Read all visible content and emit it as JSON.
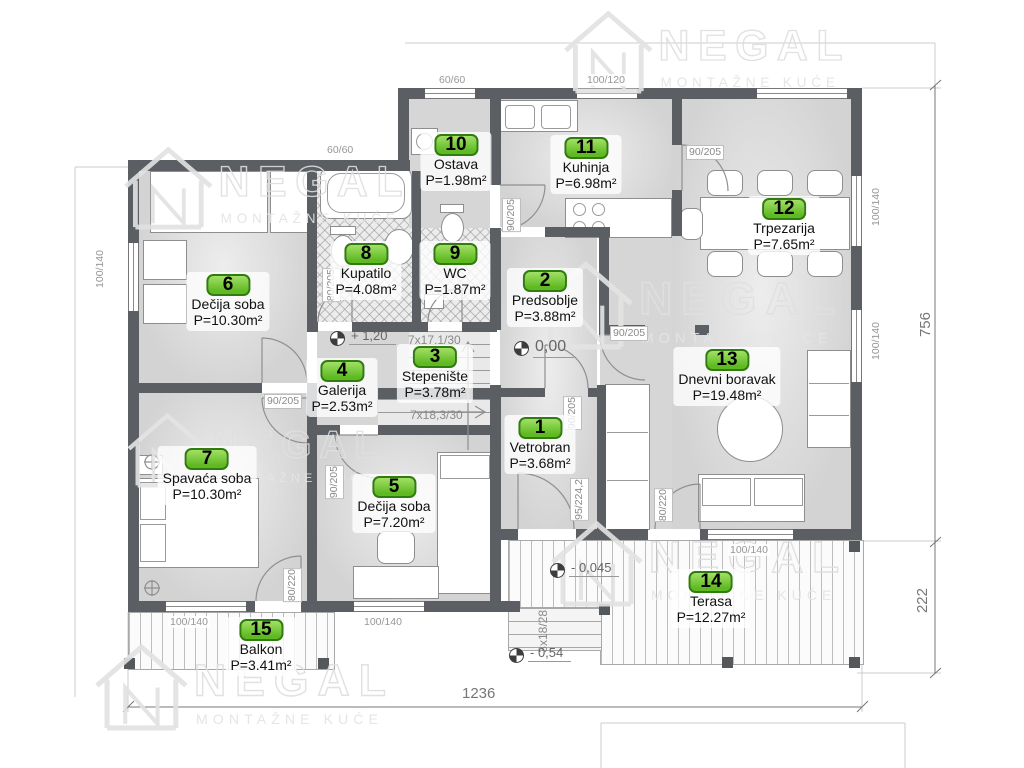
{
  "brand": {
    "name": "NEGAL",
    "tagline": "MONTAŽNE KUĆE"
  },
  "rooms": [
    {
      "num": "1",
      "name": "Vetrobran",
      "area": "P=3.68m²"
    },
    {
      "num": "2",
      "name": "Predsoblje",
      "area": "P=3.88m²"
    },
    {
      "num": "3",
      "name": "Stepenište",
      "area": "P=3.78m²"
    },
    {
      "num": "4",
      "name": "Galerija",
      "area": "P=2.53m²"
    },
    {
      "num": "5",
      "name": "Dečija soba",
      "area": "P=7.20m²"
    },
    {
      "num": "6",
      "name": "Dečija soba",
      "area": "P=10.30m²"
    },
    {
      "num": "7",
      "name": "Spavaća soba",
      "area": "P=10.30m²"
    },
    {
      "num": "8",
      "name": "Kupatilo",
      "area": "P=4.08m²"
    },
    {
      "num": "9",
      "name": "WC",
      "area": "P=1.87m²"
    },
    {
      "num": "10",
      "name": "Ostava",
      "area": "P=1.98m²"
    },
    {
      "num": "11",
      "name": "Kuhinja",
      "area": "P=6.98m²"
    },
    {
      "num": "12",
      "name": "Trpezarija",
      "area": "P=7.65m²"
    },
    {
      "num": "13",
      "name": "Dnevni boravak",
      "area": "P=19.48m²"
    },
    {
      "num": "14",
      "name": "Terasa",
      "area": "P=12.27m²"
    },
    {
      "num": "15",
      "name": "Balkon",
      "area": "P=3.41m²"
    }
  ],
  "dimensions": {
    "side": "756",
    "terrace": "222",
    "front": "1236"
  },
  "levels": {
    "upper": "+ 1,20",
    "ground": "0,00",
    "terrace": "- 0,045",
    "yard": "- 0,54"
  },
  "stairs": {
    "flight_up": "7x17,1/30",
    "flight_down": "7x18,3/30",
    "outdoor_steps": "3x18/28"
  },
  "openings": {
    "door_90_205": "90/205",
    "door_80_205": "80/205",
    "door_80_220": "80/220",
    "door_95_224": "95/224,2",
    "win_60_60": "60/60",
    "win_100_120": "100/120",
    "win_100_140": "100/140"
  },
  "colors": {
    "badge_green": "#5fb922",
    "wall_gray": "#5b5f63",
    "floor_gray": "#d6d6d6"
  }
}
